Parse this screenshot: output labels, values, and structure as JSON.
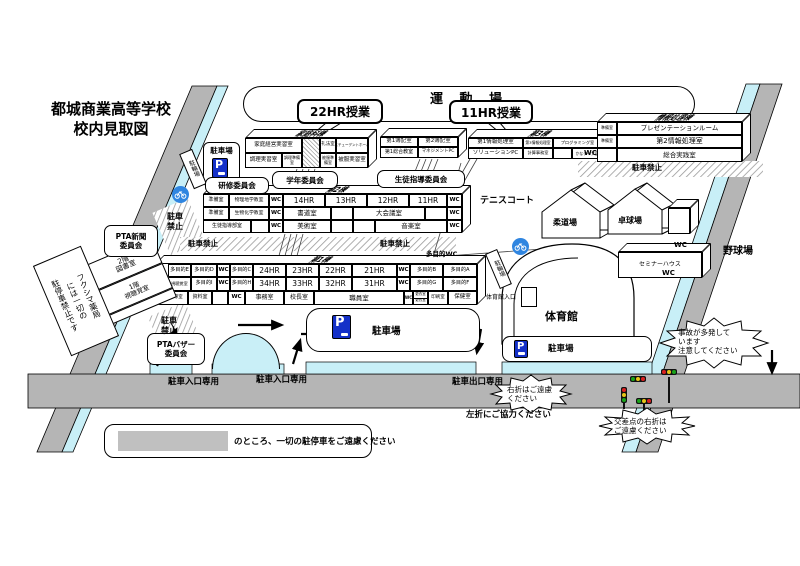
{
  "title": {
    "l1": "都城商業高等学校",
    "l2": "校内見取図"
  },
  "playground": "運 動 場",
  "callout_22hr": "22HR授業",
  "callout_11hr": "11HR授業",
  "committees": {
    "kenshu": "研修委員会",
    "gakunen": "学年委員会",
    "seishi": "生徒指導委員会",
    "pta_news": "PTA新聞\n委員会",
    "pta_bazaar": "PTAバザー\n委員会"
  },
  "bld_katei": {
    "name": "家庭科棟",
    "keiei": "家庭経営実習室",
    "reiho": "礼法室",
    "student_hall": "スチューデントホール",
    "chori": "調理実習室",
    "chori_prep": "調理準備室",
    "hifuku_prep": "被服準備室",
    "hifuku": "被服実習室"
  },
  "bld_boki": {
    "boki1": "第1簿記室",
    "boki2": "第2簿記室",
    "sogo1": "第1総合教室",
    "mgmtpc": "マネジメントPC"
  },
  "bld_no3": {
    "name": "第3棟",
    "joho1": "第1情報処理室",
    "joho3": "第3情報処理室",
    "prog": "プログラミング室",
    "solution": "ソリューションPC",
    "keisan": "計算事務室",
    "kana": "かなタイプ室"
  },
  "bld_joho": {
    "name": "情報処理棟",
    "prep": "準備室",
    "presen": "プレゼンテーションルーム",
    "joho2": "第2情報処理室",
    "jissen": "総合実践室",
    "wc": "WC"
  },
  "bld_no2": {
    "name": "第2棟",
    "prep": "準備室",
    "butsuri": "物理地学教室",
    "seibutsu": "生物化学教室",
    "seishidobu": "生徒指導部室",
    "hr14": "14HR",
    "hr13": "13HR",
    "hr12": "12HR",
    "hr11": "11HR",
    "shodo": "書道室",
    "daikaigi": "大会議室",
    "bijutsu": "美術室",
    "ongaku": "音楽室",
    "wc": "WC"
  },
  "bld_no1": {
    "name": "第1棟",
    "tamoku_wc": "多目的WC",
    "e": "多目的E",
    "d": "多目的D",
    "c": "多目的C",
    "b": "多目的B",
    "a": "多目的A",
    "i": "多目的I",
    "h": "多目的H",
    "g": "多目的G",
    "f": "多目的F",
    "av2": "第2視聴覚室",
    "hr24": "24HR",
    "hr23": "23HR",
    "hr22": "22HR",
    "hr21": "21HR",
    "hr34": "34HR",
    "hr33": "33HR",
    "hr32": "32HR",
    "hr31": "31HR",
    "shinro": "進路指導室",
    "shiryo": "資料室",
    "jimu": "事務室",
    "kocho": "校長室",
    "shokuin": "職員室",
    "koi1": "更衣室",
    "koi2": "更衣室",
    "insatsu": "印刷室",
    "hoken": "保健室",
    "wc": "WC"
  },
  "annex": {
    "f2": "2階\n図書室",
    "f1": "1階\n視聴覚室"
  },
  "fukushima": "フクシマ薬局\nには一切の\n駐停車禁止です",
  "facilities": {
    "tennis": "テニスコート",
    "judo": "柔道場",
    "takkyu": "卓球場",
    "gym": "体育館",
    "gym_ent": "体育館入口",
    "seminar": "セミナーハウス",
    "baseball": "野球場",
    "wc": "WC"
  },
  "parking": {
    "lot": "駐車場",
    "p": "P",
    "bike": "駐輪場",
    "no_parking": "駐車禁止",
    "no_parking_2line": "駐車\n禁止"
  },
  "roads": {
    "ent": "駐車入口専用",
    "exit": "駐車出口専用"
  },
  "notes": {
    "accident": "事故が多発して\nいます\n注意してください",
    "no_right": "右折はご遠慮\nください",
    "left_coop": "左折にご協力ください",
    "cross_right": "交差点の右折は\nご遠慮ください"
  },
  "legend": "のところ、一切の駐停車をご遠慮ください"
}
